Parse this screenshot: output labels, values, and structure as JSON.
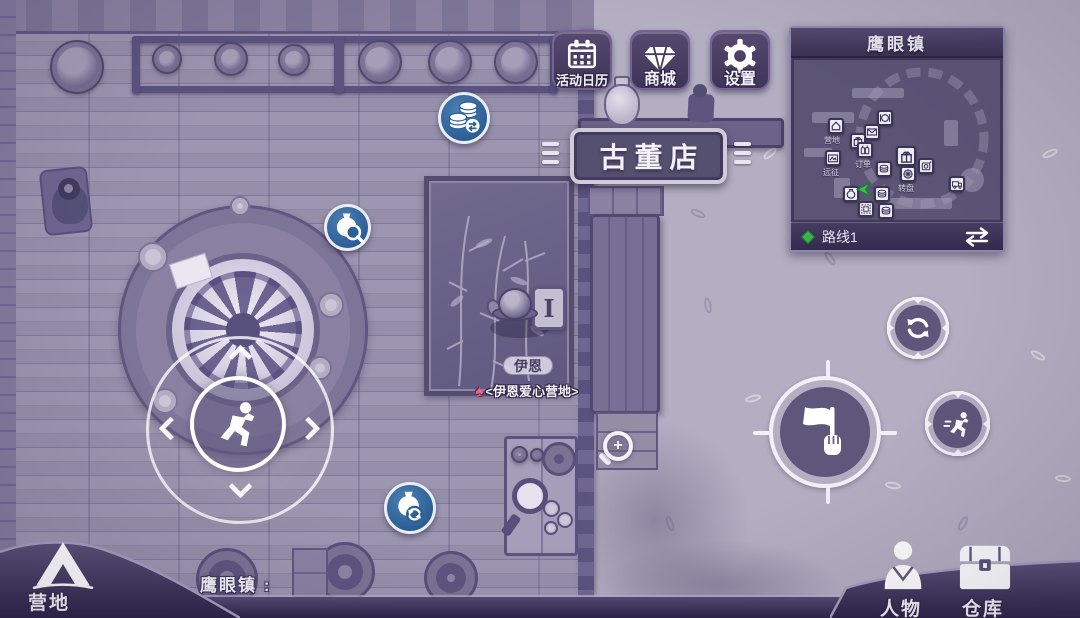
{
  "meta": {
    "scene_name": "antique shop street - top-down view"
  },
  "topbar": {
    "buttons": [
      {
        "id": "calendar",
        "label": "活动日历",
        "icon": "calendar-icon"
      },
      {
        "id": "shop",
        "label": "商城",
        "icon": "diamond-icon"
      },
      {
        "id": "settings",
        "label": "设置",
        "icon": "gear-icon"
      }
    ]
  },
  "minimap": {
    "title": "鹰眼镇",
    "route": {
      "label": "路线1",
      "marker_color": "#3cb24d"
    },
    "poi_labels": [
      "营地",
      "订单",
      "远征",
      "转盘"
    ],
    "poi_icons": [
      "restaurant-icon",
      "house-icon",
      "mail-icon",
      "gift-icon",
      "bottles-icon",
      "picture-icon",
      "gift-icon",
      "slot-icon",
      "coins-icon",
      "wheel-icon",
      "vase-icon",
      "coins-icon",
      "stamp-icon",
      "coins-icon",
      "truck-icon"
    ],
    "player_marker": "green-arrow-icon",
    "swap_icon": "swap-routes-icon"
  },
  "scene": {
    "shop_sign": "古董店",
    "location_caption": "鹰眼镇 :",
    "npc": {
      "name": "伊恩",
      "sign_letter": "I",
      "camp_tag_glyph": "♠",
      "camp_tag": "<伊恩爱心营地>"
    }
  },
  "hud": {
    "zoom_plus": "+",
    "joystick": {
      "icon": "runner-icon"
    },
    "action_buttons": [
      {
        "id": "coin-exchange",
        "icon": "coins-exchange-icon",
        "color": "#2d6096"
      },
      {
        "id": "appraise",
        "icon": "vase-magnifier-icon",
        "color": "#2d6096"
      },
      {
        "id": "restore",
        "icon": "vase-refresh-icon",
        "color": "#2d6096"
      },
      {
        "id": "refresh",
        "icon": "refresh-icon",
        "color": "#585076"
      },
      {
        "id": "flag",
        "icon": "flag-hand-icon",
        "color": "#585076"
      },
      {
        "id": "sprint",
        "icon": "runner-icon",
        "color": "#585076"
      }
    ],
    "bottom_left": {
      "label": "营地",
      "icon": "tent-icon"
    },
    "bottom_right": [
      {
        "label": "人物",
        "icon": "person-icon"
      },
      {
        "label": "仓库",
        "icon": "chest-icon"
      }
    ]
  },
  "colors": {
    "stone_ground": "#b4aec2",
    "wood_floor": "#968fa9",
    "panel_purple": "#453a61",
    "accent_blue": "#2d6096",
    "route_green": "#3cb24d",
    "spade_pink": "#ea6a8b"
  }
}
